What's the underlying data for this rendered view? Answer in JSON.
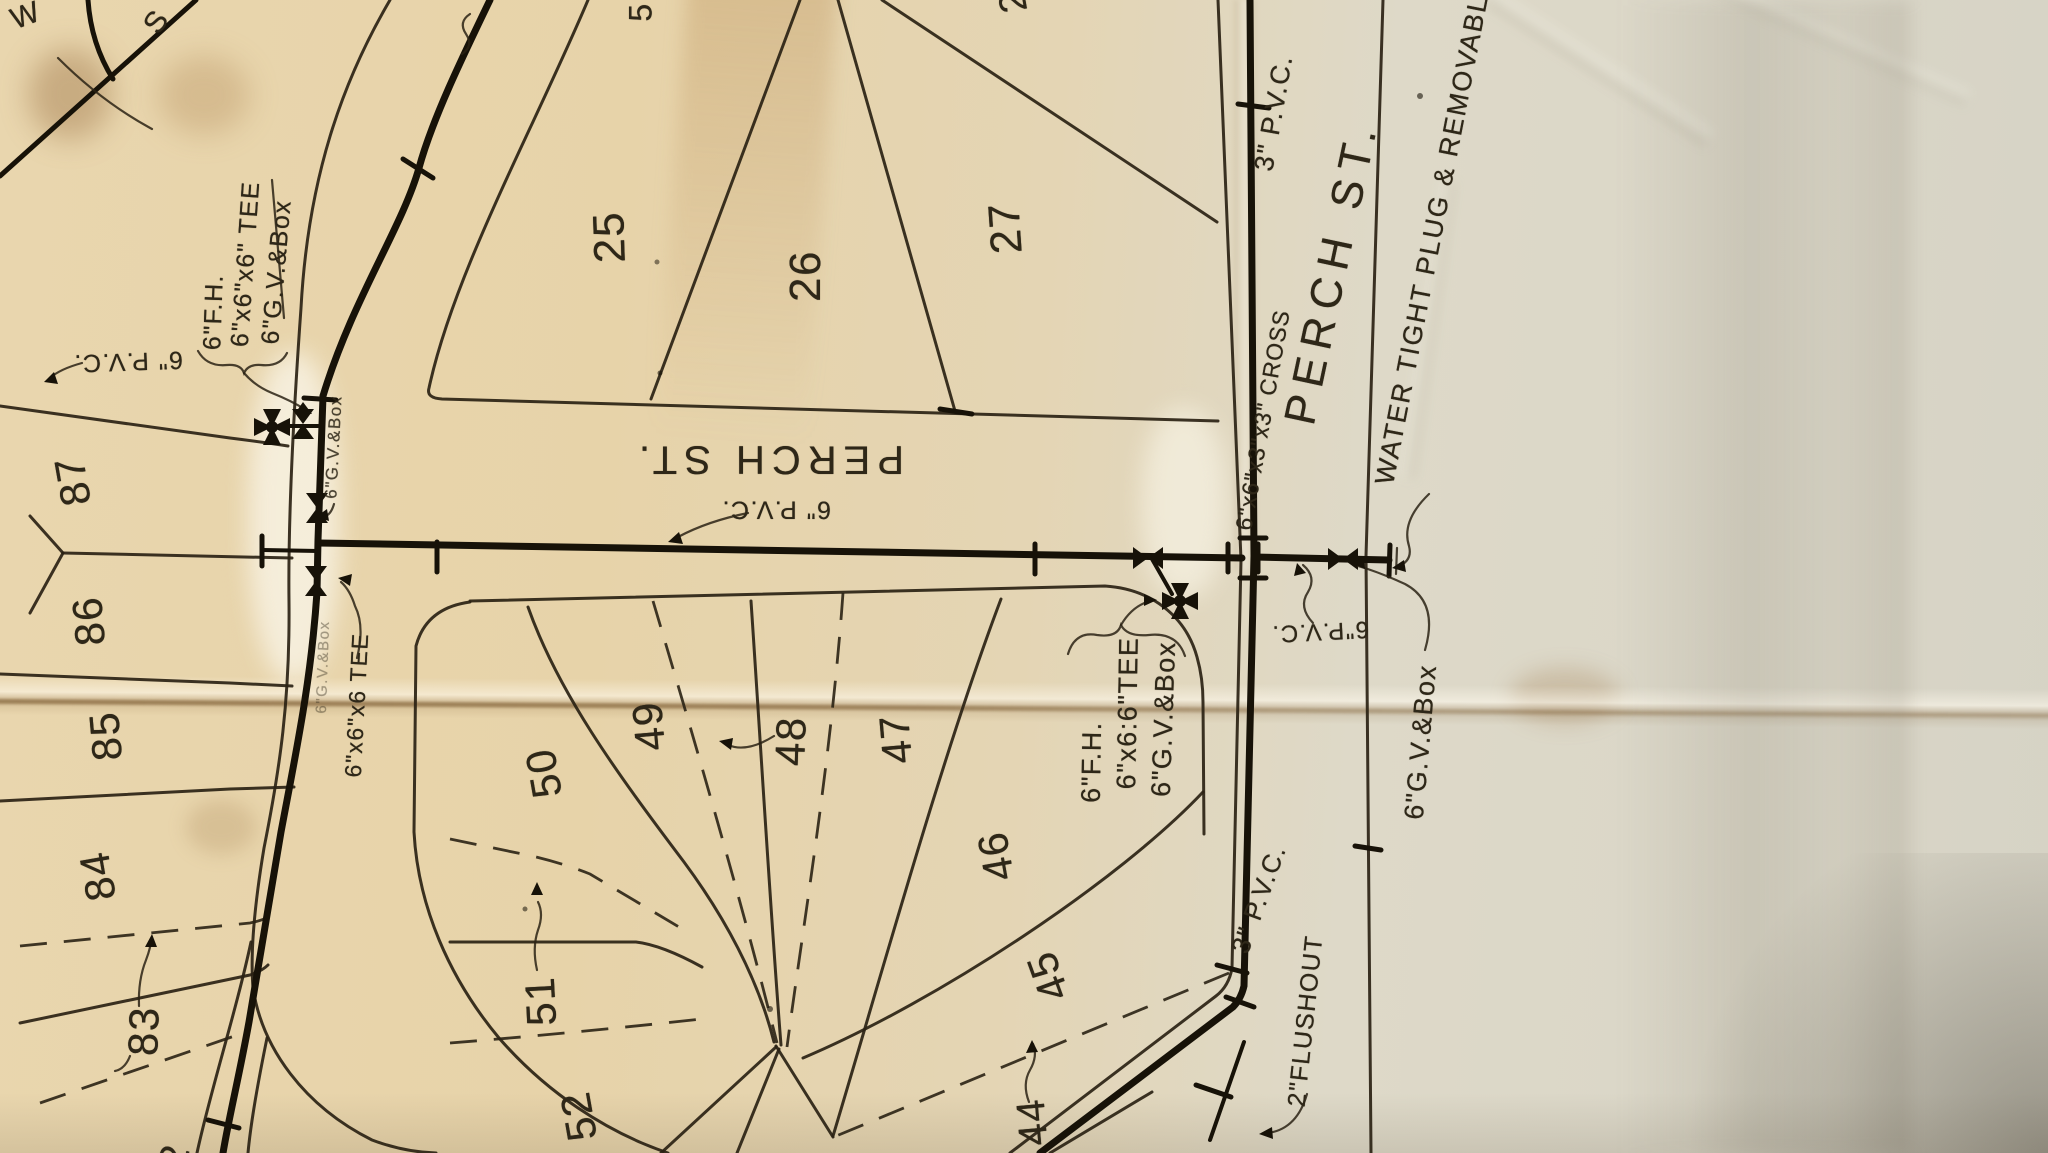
{
  "streets": {
    "perch_horizontal": "PERCH ST.",
    "perch_vertical": "PERCH ST."
  },
  "lots": {
    "n25": "25",
    "n26": "26",
    "n27": "27",
    "n28_partial": "28",
    "n44": "44",
    "n45": "45",
    "n46": "46",
    "n47": "47",
    "n48": "48",
    "n49": "49",
    "n50": "50",
    "n51": "51",
    "n52": "52",
    "n82_partial": "82",
    "n83": "83",
    "n84": "84",
    "n85": "85",
    "n86": "86",
    "n87": "87",
    "n5_partial": "5"
  },
  "annotations": {
    "tl_fh": "6\"F.H.",
    "tl_tee": "6\"x6\"x6\" TEE",
    "tl_gv": "6\"G.V.&Box",
    "tl_pvc": "6\" P.V.C.",
    "left_gv_small": "6\"G.V.&Box",
    "left_gv_faint": "6\"G.V.&Box",
    "left_tee": "6\"x6\"x6 TEE",
    "perch_pvc": "6\" P.V.C.",
    "ctr_fh": "6\"F.H.",
    "ctr_tee": "6\"x6:6\"TEE",
    "ctr_gv": "6\"G.V.&Box",
    "cross_fitting": "6\"x6\"x3\"x3\" CROSS",
    "pvc3_top": "3\" P.V.C.",
    "water_tight": "WATER TIGHT PLUG & REMOVABLE",
    "right_pvc6": "6\"P.V.C.",
    "right_gv": "6\"G.V.&Box",
    "pvc3_bottom": "3\" P.V.C.",
    "flushout": "2\"FLUSHOUT",
    "w_mark": "W",
    "s_mark": "S"
  }
}
